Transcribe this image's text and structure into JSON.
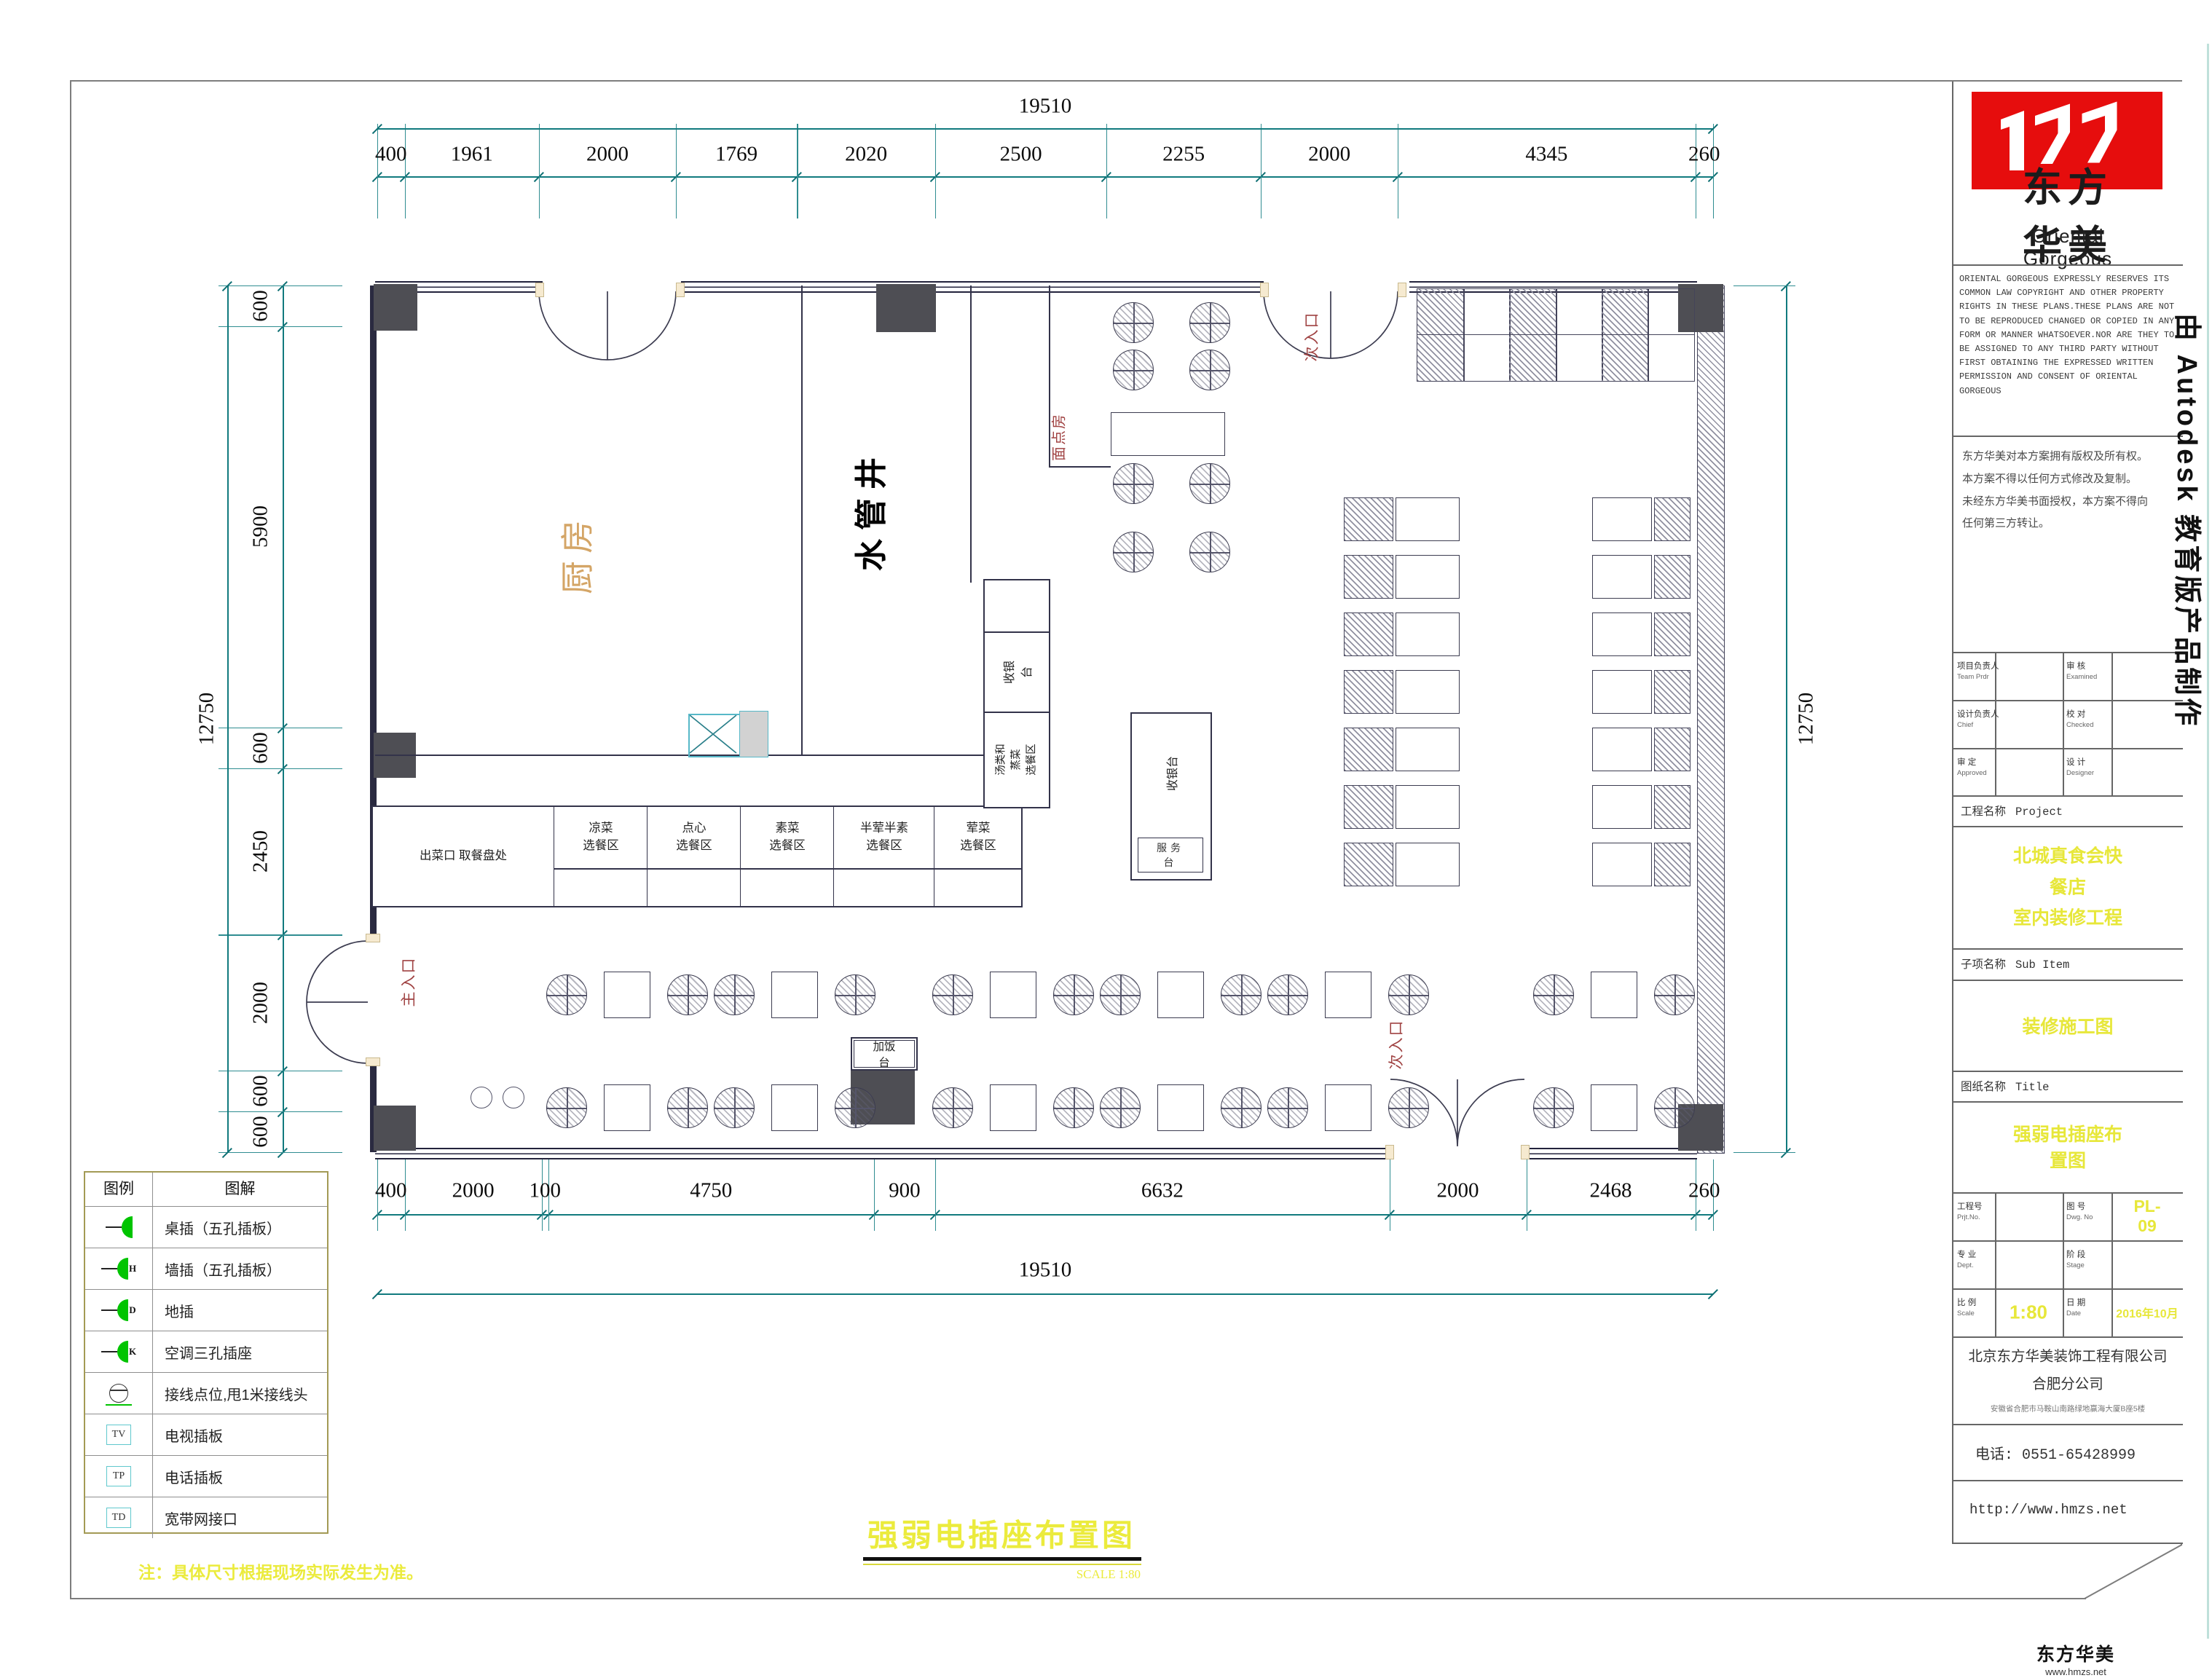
{
  "drawing": {
    "main_title": "强弱电插座布置图",
    "scale_note": "SCALE  1:80",
    "bottom_note": "注：具体尺寸根据现场实际发生为准。",
    "watermark": "由 Autodesk 教育版产品制作",
    "corner_brand": "东方华美",
    "corner_url": "www.hmzs.net"
  },
  "dims": {
    "top_total": "19510",
    "top": [
      "400",
      "1961",
      "2000",
      "1769",
      "2020",
      "2500",
      "2255",
      "2000",
      "4345",
      "260"
    ],
    "bottom_total": "19510",
    "bottom": [
      "400",
      "2000",
      "100",
      "4750",
      "900",
      "6632",
      "2000",
      "2468",
      "260"
    ],
    "left_total": "12750",
    "left": [
      "600",
      "5900",
      "600",
      "2450",
      "2000",
      "600",
      "600"
    ],
    "right_total": "12750"
  },
  "plan": {
    "kitchen": "厨房",
    "shaft": "水管井",
    "pastry": "面点房",
    "main_entrance": "主入口",
    "side_entrance_top": "次入口",
    "side_entrance_bottom": "次入口",
    "rice_station": "加饭台",
    "cashier_counter": "收银台",
    "cashier_island": "收银台",
    "service_desk": "服务台",
    "soup_area": "汤类和蒸菜\n选餐区",
    "serving_cells": [
      "出菜口  取餐盘处",
      "凉菜\n选餐区",
      "点心\n选餐区",
      "素菜\n选餐区",
      "半荤半素\n选餐区",
      "荤菜\n选餐区"
    ]
  },
  "legend": {
    "header_symbol": "图例",
    "header_desc": "图解",
    "rows": [
      {
        "icon": "socket",
        "tag": "",
        "label": "桌插（五孔插板）"
      },
      {
        "icon": "socket",
        "tag": "H",
        "label": "墙插（五孔插板）"
      },
      {
        "icon": "socket",
        "tag": "D",
        "label": "地插"
      },
      {
        "icon": "socket",
        "tag": "K",
        "label": "空调三孔插座"
      },
      {
        "icon": "junction",
        "tag": "",
        "label": "接线点位,甩1米接线头"
      },
      {
        "icon": "box",
        "tag": "TV",
        "label": "电视插板"
      },
      {
        "icon": "box",
        "tag": "TP",
        "label": "电话插板"
      },
      {
        "icon": "box",
        "tag": "TD",
        "label": "宽带网接口"
      }
    ]
  },
  "titleblock": {
    "brand_cn": "东方华美",
    "brand_en": "Oriental  Gorgeous",
    "copyright_en": "ORIENTAL GORGEOUS EXPRESSLY RESERVES ITS COMMON LAW COPYRIGHT AND OTHER PROPERTY RIGHTS IN THESE PLANS.THESE PLANS ARE NOT TO BE REPRODUCED CHANGED OR COPIED IN ANY FORM OR MANNER WHATSOEVER.NOR ARE THEY TO BE ASSIGNED TO ANY THIRD PARTY WITHOUT FIRST OBTAINING THE EXPRESSED WRITTEN PERMISSION AND CONSENT OF ORIENTAL GORGEOUS",
    "copyright_cn": "东方华美对本方案拥有版权及所有权。\n本方案不得以任何方式修改及复制。\n未经东方华美书面授权，本方案不得向\n任何第三方转让。",
    "personnel": {
      "r1c1": "项目负责人",
      "r1c1en": "Team Prdr",
      "r1v1": "",
      "r1c2": "审 核",
      "r1c2en": "Examined",
      "r1v2": "",
      "r2c1": "设计负责人",
      "r2c1en": "Chief",
      "r2v1": "",
      "r2c2": "校 对",
      "r2c2en": "Checked",
      "r2v2": "",
      "r3c1": "审 定",
      "r3c1en": "Approved",
      "r3v1": "",
      "r3c2": "设 计",
      "r3c2en": "Designer",
      "r3v2": ""
    },
    "project_label": "工程名称",
    "project_label_en": "Project",
    "project_name": "北城真食会快餐店\n室内装修工程",
    "subitem_label": "子项名称",
    "subitem_label_en": "Sub Item",
    "subitem_name": "装修施工图",
    "sheet_label": "图纸名称",
    "sheet_label_en": "Title",
    "sheet_name": "强弱电插座布置图",
    "grid": {
      "r1c1": "工程号",
      "r1c1en": "Prjt.No.",
      "r1v1": "",
      "r1c2": "图 号",
      "r1c2en": "Dwg. No",
      "r1v2": "PL-09",
      "r2c1": "专 业",
      "r2c1en": "Dept.",
      "r2v1": "",
      "r2c2": "阶 段",
      "r2c2en": "Stage",
      "r2v2": "",
      "r3c1": "比 例",
      "r3c1en": "Scale",
      "r3v1": "1:80",
      "r3c2": "日 期",
      "r3c2en": "Date",
      "r3v2": "2016年10月"
    },
    "company": "北京东方华美装饰工程有限公司",
    "branch": "合肥分公司",
    "address": "安徽省合肥市马鞍山南路绿地赢海大厦B座5楼",
    "phone": "电话: 0551-65428999",
    "website": "http://www.hmzs.net"
  }
}
